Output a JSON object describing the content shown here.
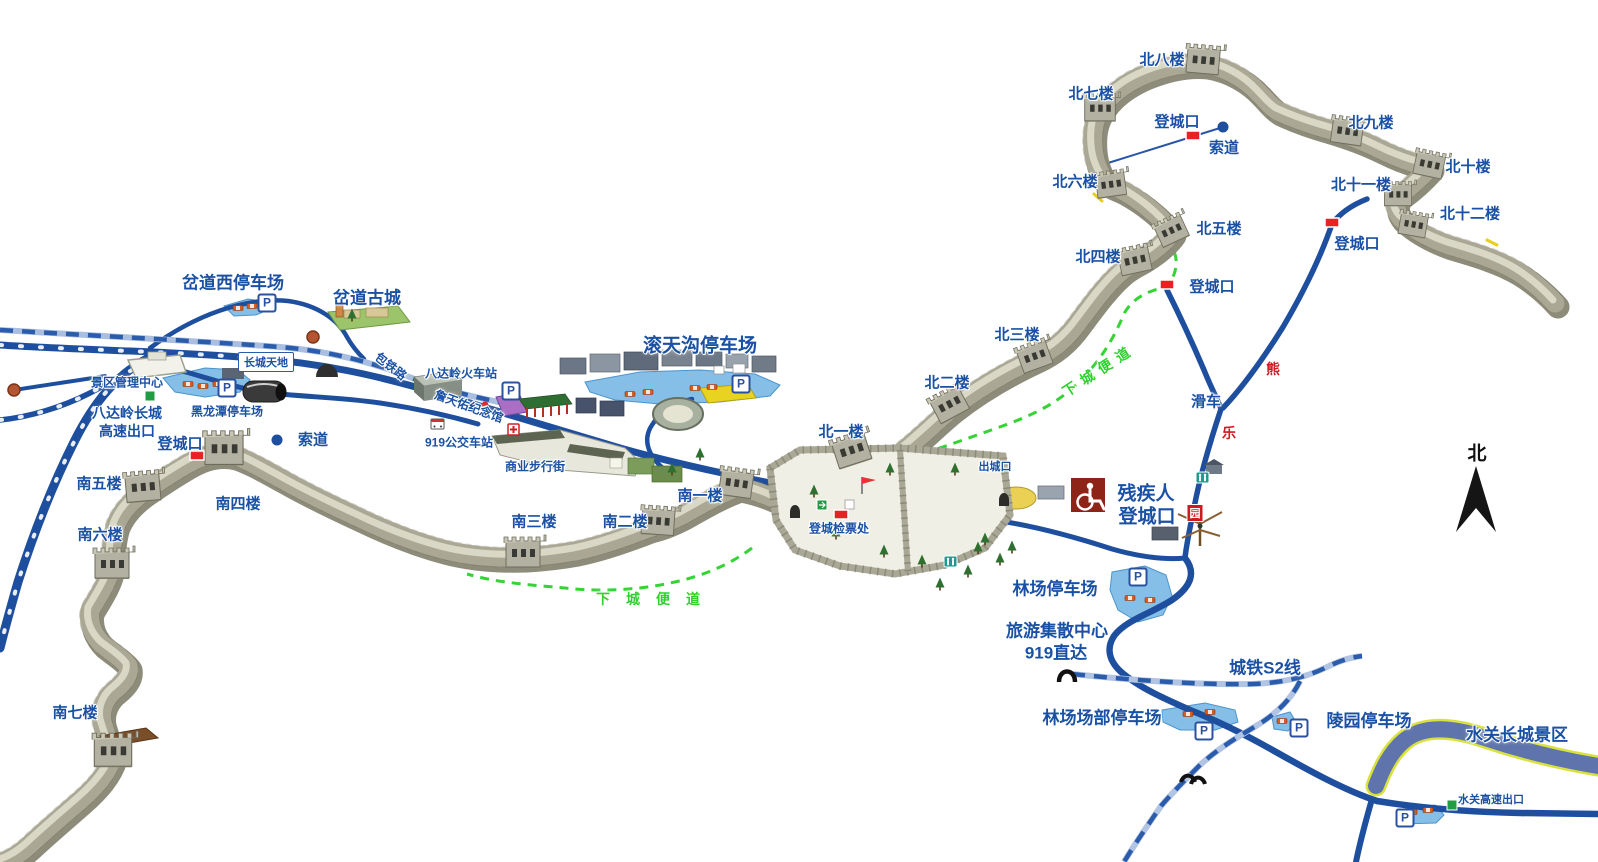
{
  "map": {
    "region": "八达岭长城景区导览地图",
    "colors": {
      "label_blue": "#1a51a5",
      "road_blue": "#1e4f9f",
      "rail_base": "#a9bee0",
      "rail_dash": "#2b5cab",
      "green_path": "#35d435",
      "red_marker": "#e82222",
      "bear_red": "#cc1b22",
      "water_blue": "#85bfe8",
      "wall_gray": "#c5c3b2",
      "disabled_box_maroon": "#8e2318",
      "exit_green": "#1f9c44",
      "yellow_lot": "#e8d321"
    }
  },
  "labels": [
    {
      "name": "tower-bei-8",
      "text": "北八楼",
      "x": 1162,
      "y": 59,
      "cls": "t-md"
    },
    {
      "name": "tower-bei-7",
      "text": "北七楼",
      "x": 1091,
      "y": 93,
      "cls": "t-md"
    },
    {
      "name": "tower-bei-9",
      "text": "北九楼",
      "x": 1371,
      "y": 122,
      "cls": "t-md"
    },
    {
      "name": "tower-bei-10",
      "text": "北十楼",
      "x": 1468,
      "y": 166,
      "cls": "t-md"
    },
    {
      "name": "tower-bei-11",
      "text": "北十一楼",
      "x": 1361,
      "y": 184,
      "cls": "t-md"
    },
    {
      "name": "tower-bei-12",
      "text": "北十二楼",
      "x": 1470,
      "y": 213,
      "cls": "t-md"
    },
    {
      "name": "tower-bei-6",
      "text": "北六楼",
      "x": 1075,
      "y": 181,
      "cls": "t-md"
    },
    {
      "name": "tower-bei-5",
      "text": "北五楼",
      "x": 1219,
      "y": 228,
      "cls": "t-md"
    },
    {
      "name": "tower-bei-4",
      "text": "北四楼",
      "x": 1098,
      "y": 256,
      "cls": "t-md"
    },
    {
      "name": "tower-bei-3",
      "text": "北三楼",
      "x": 1017,
      "y": 334,
      "cls": "t-md"
    },
    {
      "name": "tower-bei-2",
      "text": "北二楼",
      "x": 947,
      "y": 382,
      "cls": "t-md"
    },
    {
      "name": "tower-bei-1",
      "text": "北一楼",
      "x": 841,
      "y": 431,
      "cls": "t-md"
    },
    {
      "name": "tower-nan-1",
      "text": "南一楼",
      "x": 700,
      "y": 495,
      "cls": "t-md"
    },
    {
      "name": "tower-nan-2",
      "text": "南二楼",
      "x": 625,
      "y": 521,
      "cls": "t-md"
    },
    {
      "name": "tower-nan-3",
      "text": "南三楼",
      "x": 534,
      "y": 521,
      "cls": "t-md"
    },
    {
      "name": "tower-nan-4",
      "text": "南四楼",
      "x": 238,
      "y": 503,
      "cls": "t-md"
    },
    {
      "name": "tower-nan-5",
      "text": "南五楼",
      "x": 99,
      "y": 483,
      "cls": "t-md"
    },
    {
      "name": "tower-nan-6",
      "text": "南六楼",
      "x": 100,
      "y": 534,
      "cls": "t-md"
    },
    {
      "name": "tower-nan-7",
      "text": "南七楼",
      "x": 75,
      "y": 712,
      "cls": "t-md"
    },
    {
      "name": "entrance-north-cableway",
      "text": "登城口",
      "x": 1177,
      "y": 121,
      "cls": "t-md"
    },
    {
      "name": "entrance-northeast",
      "text": "登城口",
      "x": 1357,
      "y": 243,
      "cls": "t-md"
    },
    {
      "name": "entrance-bei4",
      "text": "登城口",
      "x": 1212,
      "y": 286,
      "cls": "t-md"
    },
    {
      "name": "entrance-west",
      "text": "登城口",
      "x": 180,
      "y": 443,
      "cls": "t-md"
    },
    {
      "name": "cableway-north",
      "text": "索道",
      "x": 1224,
      "y": 147,
      "cls": "t-md"
    },
    {
      "name": "cableway-west",
      "text": "索道",
      "x": 313,
      "y": 439,
      "cls": "t-md"
    },
    {
      "name": "slide-car",
      "text": "滑车",
      "x": 1206,
      "y": 401,
      "cls": "t-md"
    },
    {
      "name": "descend-path-east",
      "text": "下城便道",
      "x": 1099,
      "y": 370,
      "cls": "t-green rot",
      "rot": -33
    },
    {
      "name": "descend-path-south",
      "text": "下城便道",
      "x": 656,
      "y": 599,
      "cls": "t-green spread"
    },
    {
      "name": "bear-park-char-xiong",
      "text": "熊",
      "x": 1273,
      "y": 369,
      "cls": "t-red"
    },
    {
      "name": "bear-park-char-le",
      "text": "乐",
      "x": 1229,
      "y": 433,
      "cls": "t-red"
    },
    {
      "name": "bear-park-char-yuan",
      "text": "园",
      "x": 1195,
      "y": 513,
      "cls": "b-red"
    },
    {
      "name": "chadao-west-parking",
      "text": "岔道西停车场",
      "x": 233,
      "y": 281,
      "cls": "t-lg"
    },
    {
      "name": "chadao-ancient-town",
      "text": "岔道古城",
      "x": 367,
      "y": 296,
      "cls": "t-lg"
    },
    {
      "name": "guntiangou-parking",
      "text": "滚天沟停车场",
      "x": 700,
      "y": 344,
      "cls": "t-xl"
    },
    {
      "name": "great-wall-tiandi",
      "text": "长城天地",
      "x": 266,
      "y": 362,
      "cls": "t-box"
    },
    {
      "name": "scenic-mgmt-center",
      "text": "景区管理中心",
      "x": 127,
      "y": 382,
      "cls": "t-sm"
    },
    {
      "name": "badaling-expwy-exit-line1",
      "text": "八达岭长城",
      "x": 127,
      "y": 413,
      "cls": "t-md2"
    },
    {
      "name": "badaling-expwy-exit-line2",
      "text": "高速出口",
      "x": 127,
      "y": 431,
      "cls": "t-md2"
    },
    {
      "name": "heilongtan-parking",
      "text": "黑龙潭停车场",
      "x": 227,
      "y": 411,
      "cls": "t-sm"
    },
    {
      "name": "jingbao-railway",
      "text": "包铁路",
      "x": 391,
      "y": 366,
      "cls": "t-sm",
      "rot": 38
    },
    {
      "name": "badaling-rail-station",
      "text": "八达岭火车站",
      "x": 461,
      "y": 373,
      "cls": "t-sm"
    },
    {
      "name": "zhantianyou-memorial",
      "text": "詹天佑纪念馆",
      "x": 469,
      "y": 406,
      "cls": "t-sm",
      "rot": 20
    },
    {
      "name": "bus-919-station",
      "text": "919公交车站",
      "x": 459,
      "y": 442,
      "cls": "t-sm"
    },
    {
      "name": "commercial-street",
      "text": "商业步行街",
      "x": 535,
      "y": 466,
      "cls": "t-sm"
    },
    {
      "name": "exit-city-gate",
      "text": "出城口",
      "x": 995,
      "y": 466,
      "cls": "t-xs"
    },
    {
      "name": "ticket-check",
      "text": "登城检票处",
      "x": 839,
      "y": 528,
      "cls": "t-sm"
    },
    {
      "name": "disabled-entrance-line1",
      "text": "残疾人",
      "x": 1146,
      "y": 492,
      "cls": "t-xl"
    },
    {
      "name": "disabled-entrance-line2",
      "text": "登城口",
      "x": 1147,
      "y": 515,
      "cls": "t-xl"
    },
    {
      "name": "linchang-parking",
      "text": "林场停车场",
      "x": 1055,
      "y": 587,
      "cls": "t-lg"
    },
    {
      "name": "tourist-center",
      "text": "旅游集散中心",
      "x": 1057,
      "y": 629,
      "cls": "t-lg"
    },
    {
      "name": "bus-919-direct",
      "text": "919直达",
      "x": 1056,
      "y": 651,
      "cls": "t-lg"
    },
    {
      "name": "s2-rail-line",
      "text": "城铁S2线",
      "x": 1265,
      "y": 666,
      "cls": "t-lg"
    },
    {
      "name": "linchang-hq-parking",
      "text": "林场场部停车场",
      "x": 1102,
      "y": 716,
      "cls": "t-lg"
    },
    {
      "name": "lingyuan-parking",
      "text": "陵园停车场",
      "x": 1369,
      "y": 719,
      "cls": "t-lg"
    },
    {
      "name": "shuiguan-scenic-area",
      "text": "水关长城景区",
      "x": 1517,
      "y": 733,
      "cls": "t-lg"
    },
    {
      "name": "shuiguan-expwy-exit",
      "text": "水关高速出口",
      "x": 1491,
      "y": 799,
      "cls": "t-xs"
    },
    {
      "name": "compass-north-label",
      "text": "北",
      "x": 1477,
      "y": 452,
      "cls": "t-compass"
    },
    {
      "name": "parking-sign-chadao",
      "text": "P",
      "x": 267,
      "y": 303,
      "cls": "p-sign"
    },
    {
      "name": "parking-sign-heilongtan",
      "text": "P",
      "x": 227,
      "y": 388,
      "cls": "p-sign"
    },
    {
      "name": "parking-sign-zhantianyou",
      "text": "P",
      "x": 511,
      "y": 391,
      "cls": "p-sign"
    },
    {
      "name": "parking-sign-guntiangou",
      "text": "P",
      "x": 741,
      "y": 384,
      "cls": "p-sign"
    },
    {
      "name": "parking-sign-linchang",
      "text": "P",
      "x": 1138,
      "y": 577,
      "cls": "p-sign"
    },
    {
      "name": "parking-sign-linchang-hq",
      "text": "P",
      "x": 1204,
      "y": 731,
      "cls": "p-sign"
    },
    {
      "name": "parking-sign-lingyuan",
      "text": "P",
      "x": 1299,
      "y": 728,
      "cls": "p-sign"
    },
    {
      "name": "parking-sign-shuiguan",
      "text": "P",
      "x": 1405,
      "y": 818,
      "cls": "p-sign"
    }
  ]
}
